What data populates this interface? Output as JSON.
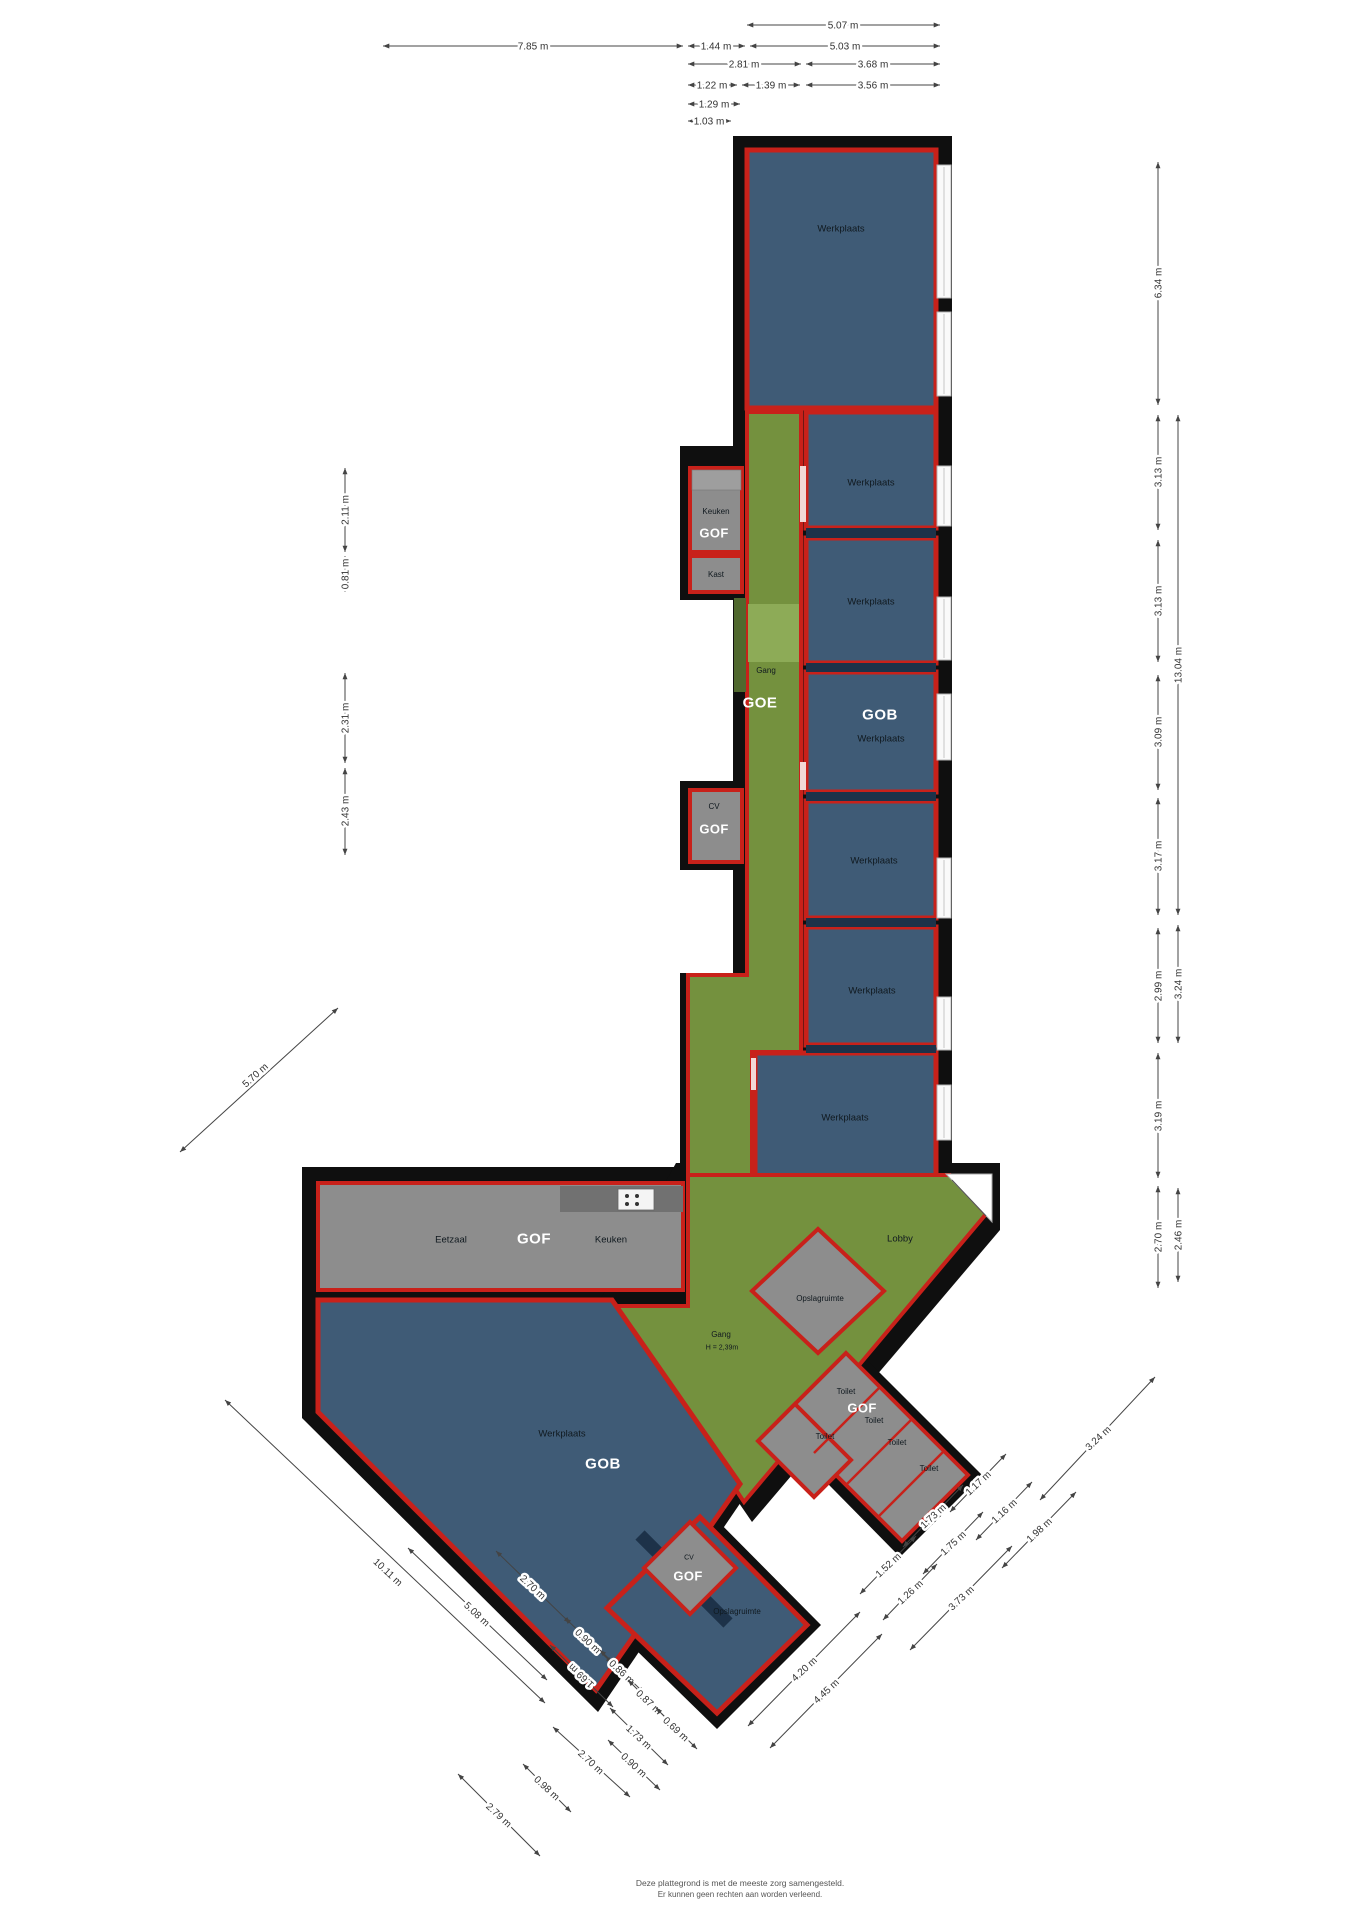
{
  "plan_colors": {
    "wall": "#0f0f0f",
    "workshop_blue": "#3f5b76",
    "corridor_green": "#74913e",
    "room_gray": "#8d8d8d",
    "outline_red": "#c8211a",
    "divider_navy": "#1d3249"
  },
  "rooms": [
    {
      "label": "Werkplaats"
    },
    {
      "label": "Werkplaats"
    },
    {
      "label": "Werkplaats"
    },
    {
      "code": "GOB",
      "label": "Werkplaats"
    },
    {
      "label": "Werkplaats"
    },
    {
      "label": "Werkplaats"
    },
    {
      "label": "Werkplaats"
    },
    {
      "code": "GOE",
      "label": "Gang"
    },
    {
      "code": "GOF",
      "label": "Keuken"
    },
    {
      "label": "Kast"
    },
    {
      "code": "GOF",
      "label": "CV"
    },
    {
      "code": "GOF",
      "label_left": "Eetzaal",
      "label_right": "Keuken"
    },
    {
      "label": "Lobby"
    },
    {
      "label": "Opslagruimte"
    },
    {
      "label": "Gang",
      "height_note": "H = 2,39m"
    },
    {
      "code": "GOB",
      "label": "Werkplaats"
    },
    {
      "label": "Opslagruimte"
    },
    {
      "code": "GOF",
      "labels": [
        "Toilet",
        "Toilet",
        "Toilet",
        "Toilet",
        "Toilet"
      ]
    },
    {
      "code": "GOF",
      "label": "CV"
    }
  ],
  "dimensions": {
    "top": [
      "5.07 m",
      "7.85 m",
      "1.44 m",
      "5.03 m",
      "2.81 m",
      "3.68 m",
      "1.22 m",
      "1.39 m",
      "3.56 m",
      "1.29 m",
      "1.03 m"
    ],
    "right_inner": [
      "6.34 m",
      "3.13 m",
      "3.13 m",
      "3.09 m",
      "3.17 m",
      "2.99 m",
      "3.19 m",
      "2.70 m"
    ],
    "right_outer": [
      "13.04 m",
      "3.24 m",
      "2.46 m"
    ],
    "left": [
      "2.11 m",
      "0.81 m",
      "2.31 m",
      "2.43 m"
    ],
    "left_diagonal": [
      "5.70 m"
    ],
    "bottom_left": [
      "10.11 m",
      "5.08 m",
      "2.70 m",
      "0.90 m",
      "1.69 m",
      "0.86 m",
      "0.87 m",
      "0.69 m",
      "1.73 m",
      "0.90 m",
      "2.70 m",
      "0.98 m",
      "2.79 m"
    ],
    "bottom_right": [
      "3.24 m",
      "1.17 m",
      "1.16 m",
      "1.98 m",
      "1.73 m",
      "1.75 m",
      "1.52 m",
      "1.26 m",
      "3.73 m",
      "4.20 m",
      "4.45 m"
    ]
  },
  "footer": {
    "line1": "Deze plattegrond is met de meeste zorg samengesteld.",
    "line2": "Er kunnen geen rechten aan worden verleend."
  }
}
